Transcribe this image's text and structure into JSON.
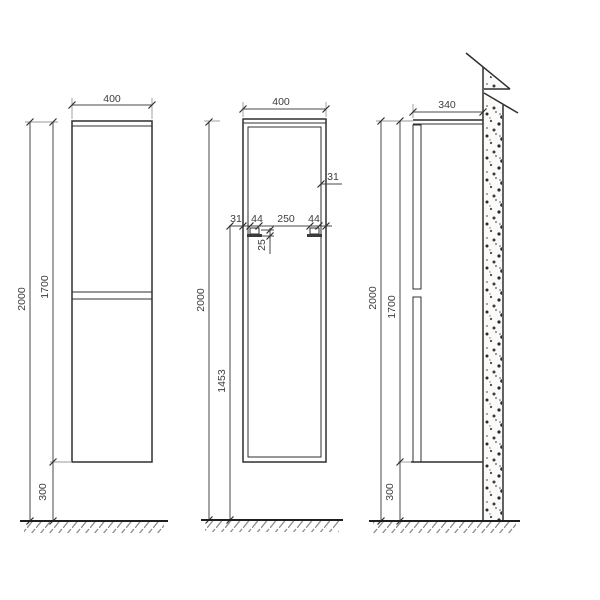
{
  "drawing": {
    "kind": "wall-hung tall cabinet installation drawing",
    "views": {
      "front": {
        "width": "400",
        "total_height": "2000",
        "cabinet_height": "1700",
        "floor_clearance": "300"
      },
      "carcass": {
        "width": "400",
        "total_height": "2000",
        "bracket_height_from_floor": "1453",
        "bracket_edge_offset": "31",
        "bracket_width_left": "44",
        "bracket_spacing": "250",
        "bracket_width_right": "44",
        "bracket_drop": "25",
        "side_panel_offset": "31"
      },
      "side": {
        "depth": "340",
        "total_height": "2000",
        "cabinet_height": "1700",
        "floor_clearance": "300"
      }
    },
    "colors": {
      "line": "#2f2f2f",
      "dimension": "#4a4a4a",
      "text": "#3d3d3d",
      "background": "#ffffff",
      "wall_speckle": "#2b2b2b",
      "hatch": "#8a8a8a"
    }
  }
}
